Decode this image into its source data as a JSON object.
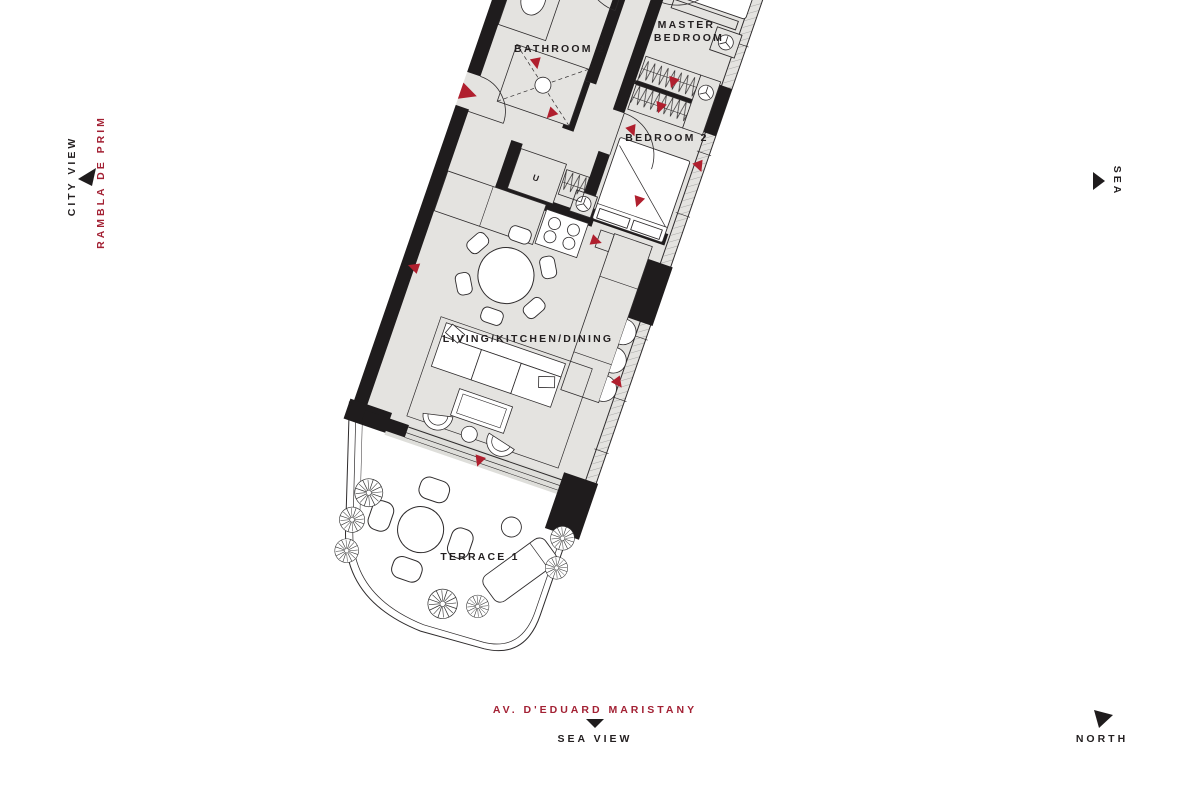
{
  "page": {
    "background": "#ffffff",
    "type": "apartment floor plan"
  },
  "colors": {
    "floor_fill": "#e4e3e0",
    "wall_black": "#1f1c1d",
    "line": "#2e2b2c",
    "accent_red": "#a32134",
    "marker_red": "#b01f2e",
    "white": "#ffffff"
  },
  "floor_plan": {
    "rooms": {
      "bathroom_2": {
        "label": "BATHROOM 2"
      },
      "master_bedroom": {
        "line1": "MASTER",
        "line2": "BEDROOM"
      },
      "bedroom_2": {
        "label": "BEDROOM 2"
      },
      "living_kitchen_dining": {
        "label": "LIVING/KITCHEN/DINING"
      },
      "terrace_1": {
        "label": "TERRACE 1"
      },
      "utility": {
        "label": "U"
      }
    }
  },
  "annotations": {
    "city_view": "CITY VIEW",
    "rambla_de_prim": "RAMBLA DE PRIM",
    "sea": "SEA",
    "av_eduard_maristany": "AV. D'EDUARD MARISTANY",
    "sea_view": "SEA VIEW",
    "north": "NORTH"
  }
}
